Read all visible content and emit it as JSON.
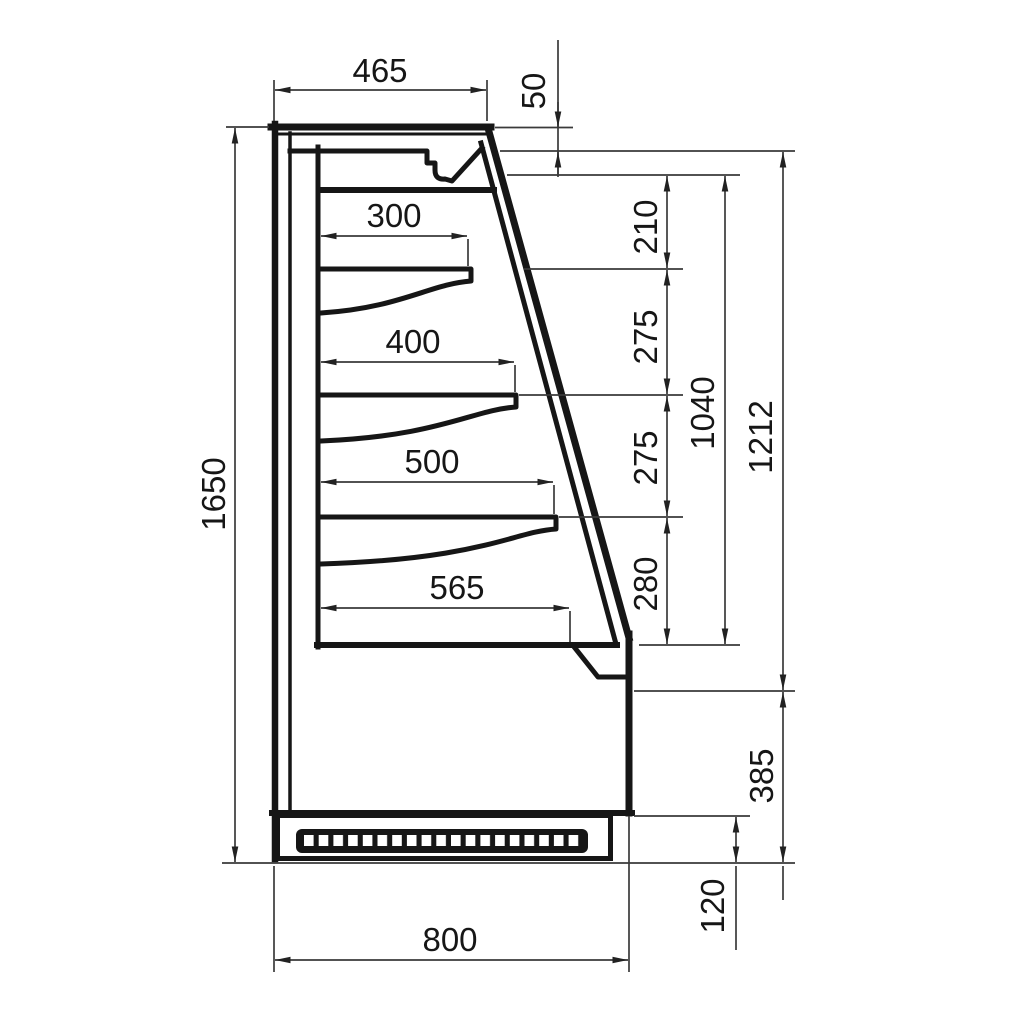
{
  "drawing": {
    "description": "Technical side-section dimension drawing of a refrigerated wall display case with three shelves, canopy, glass front and ventilated plinth",
    "units": "mm",
    "colors": {
      "line": "#161616",
      "thin_line": "#3a3a3a",
      "background": "#ffffff"
    },
    "dims": {
      "top_depth": "465",
      "canopy_front_height": "50",
      "shelf_1_depth": "300",
      "shelf_2_depth": "400",
      "shelf_3_depth": "500",
      "base_shelf_depth": "565",
      "gap_canopy_shelf1": "210",
      "gap_shelf1_shelf2": "275",
      "gap_shelf2_shelf3": "275",
      "gap_shelf3_deck": "280",
      "opening_height": "1040",
      "glass_front_height": "1212",
      "lower_body_height": "385",
      "plinth_height": "120",
      "total_height": "1650",
      "total_depth": "800"
    }
  }
}
